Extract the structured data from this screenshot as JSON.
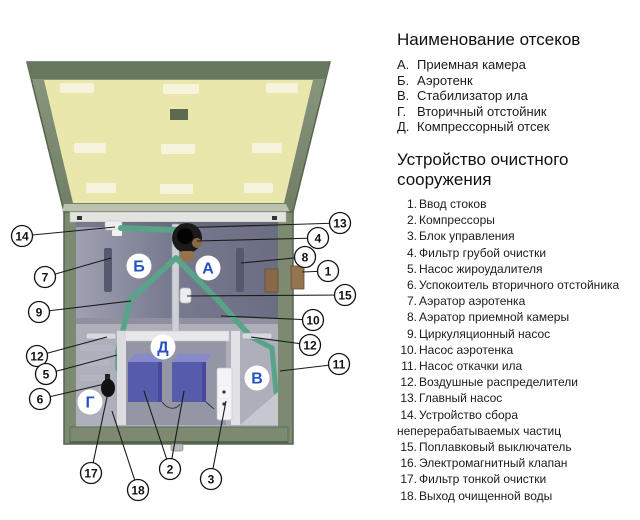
{
  "diagram": {
    "letters": [
      "Б",
      "А",
      "Д",
      "В",
      "Г"
    ],
    "callouts": [
      "13",
      "4",
      "8",
      "1",
      "15",
      "10",
      "12",
      "11",
      "14",
      "7",
      "9",
      "12",
      "5",
      "6",
      "17",
      "18",
      "2",
      "3"
    ],
    "palette": {
      "tank_green": "#7c8a72",
      "lid_inner_yellow": "#eae7ad",
      "pipe_green": "#58a488",
      "compressor_blue": "#575bac",
      "letter_blue": "#2452c0"
    }
  },
  "compartments": {
    "title": "Наименование отсеков",
    "items": [
      {
        "num": "А.",
        "label": "Приемная камера"
      },
      {
        "num": "Б.",
        "label": "Аэротенк"
      },
      {
        "num": "В.",
        "label": "Стабилизатор ила"
      },
      {
        "num": "Г.",
        "label": "Вторичный отстойник"
      },
      {
        "num": "Д.",
        "label": "Компрессорный отсек"
      }
    ]
  },
  "device": {
    "title": "Устройство очистного сооружения",
    "items": [
      {
        "num": "1.",
        "label": "Ввод стоков"
      },
      {
        "num": "2.",
        "label": "Компрессоры"
      },
      {
        "num": "3.",
        "label": "Блок управления"
      },
      {
        "num": "4.",
        "label": "Фильтр грубой очистки"
      },
      {
        "num": "5.",
        "label": "Насос жироудалителя"
      },
      {
        "num": "6.",
        "label": "Успокоитель вторичного отстойника"
      },
      {
        "num": "7.",
        "label": "Аэратор аэротенка"
      },
      {
        "num": "8.",
        "label": "Аэратор приемной камеры"
      },
      {
        "num": "9.",
        "label": "Циркуляционный насос"
      },
      {
        "num": "10.",
        "label": "Насос аэротенка"
      },
      {
        "num": "11.",
        "label": "Насос откачки ила"
      },
      {
        "num": "12.",
        "label": "Воздушные распределители"
      },
      {
        "num": "13.",
        "label": "Главный насос"
      },
      {
        "num": "14.",
        "label": "Устройство сбора неперерабатываемых частиц"
      },
      {
        "num": "15.",
        "label": "Поплавковый выключатель"
      },
      {
        "num": "16.",
        "label": "Электромагнитный клапан"
      },
      {
        "num": "17.",
        "label": "Фильтр тонкой очистки"
      },
      {
        "num": "18.",
        "label": "Выход очищенной воды"
      }
    ]
  }
}
